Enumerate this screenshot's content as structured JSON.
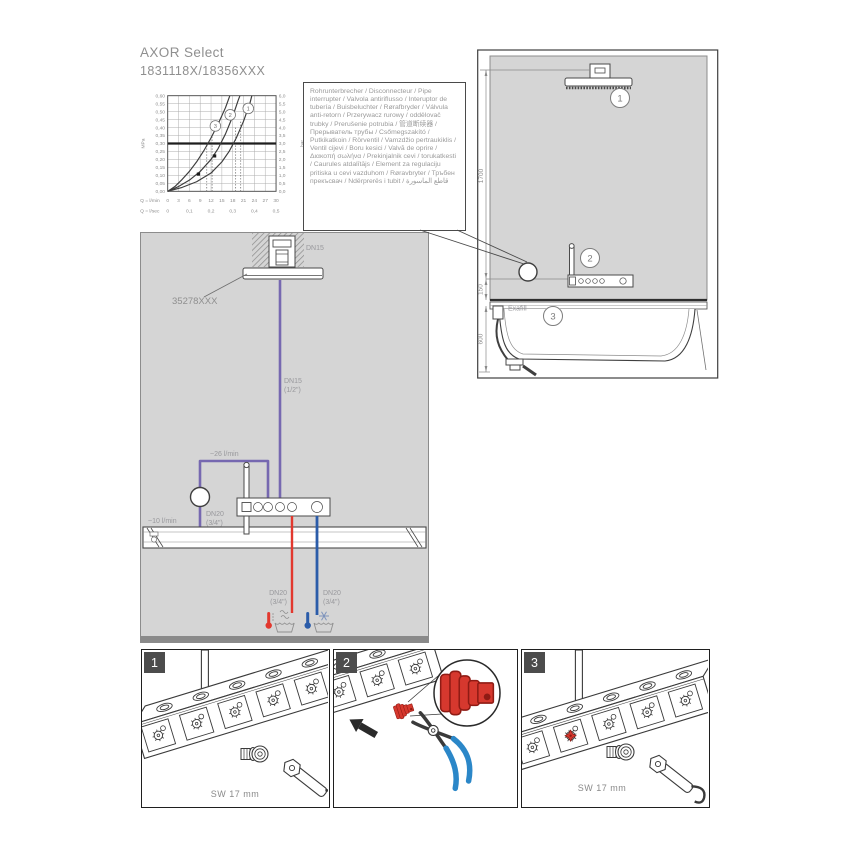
{
  "header": {
    "title": "AXOR Select",
    "subtitle": "1831118X/18356XXX"
  },
  "note_box": {
    "text": "Rohrunterbrecher / Disconnecteur / Pipe interrupter / Valvola antiriflusso / Interuptor de tubería / Buisbeluchter / Rørafbryder / Válvula anti-retorn / Przerywacz rurowy / oddělovač trubky / Prerušenie potrubia / 管道断续器 / Прерыватель трубы / Csőmegszakító / Putkikatkoin / Rörventil / Vamzdžio pertraukiklis / Ventil cijevi / Boru kesici / Valvă de oprire / Διακοπή σωλήνα / Prekinjalnik cevi / torukatkesti / Caurules atdalītājs / Element za regulaciju pritiska u cevi vazduhom / Røravbryter / Тръбен прекъсвач / Ndërprerës i tubit / قاطع الماسورة"
  },
  "chart_data": {
    "type": "line",
    "title": "",
    "xlabel_row1": "Q = l/min",
    "xlabel_row2": "Q = l/sec",
    "y_left_unit": "MPa",
    "y_right_unit": "bar",
    "x_range_lmin": [
      0,
      30
    ],
    "y_range_mpa": [
      0,
      0.6
    ],
    "grid": true,
    "y_ticks": [
      {
        "mpa": 0.6,
        "left": "0,60",
        "right": "6,0"
      },
      {
        "mpa": 0.55,
        "left": "0,55",
        "right": "5,5"
      },
      {
        "mpa": 0.5,
        "left": "0,50",
        "right": "5,0"
      },
      {
        "mpa": 0.45,
        "left": "0,45",
        "right": "4,5"
      },
      {
        "mpa": 0.4,
        "left": "0,40",
        "right": "4,0"
      },
      {
        "mpa": 0.35,
        "left": "0,35",
        "right": "3,5"
      },
      {
        "mpa": 0.3,
        "left": "0,30",
        "right": "3,0"
      },
      {
        "mpa": 0.25,
        "left": "0,25",
        "right": "2,5"
      },
      {
        "mpa": 0.2,
        "left": "0,20",
        "right": "2,0"
      },
      {
        "mpa": 0.15,
        "left": "0,15",
        "right": "1,5"
      },
      {
        "mpa": 0.1,
        "left": "0,10",
        "right": "1,0"
      },
      {
        "mpa": 0.05,
        "left": "0,05",
        "right": "0,5"
      },
      {
        "mpa": 0.0,
        "left": "0,00",
        "right": "0,0"
      }
    ],
    "x_lmin_ticks": [
      {
        "x": 0,
        "label": "0"
      },
      {
        "x": 3,
        "label": "3"
      },
      {
        "x": 6,
        "label": "6"
      },
      {
        "x": 9,
        "label": "9"
      },
      {
        "x": 12,
        "label": "12"
      },
      {
        "x": 15,
        "label": "15"
      },
      {
        "x": 18,
        "label": "18"
      },
      {
        "x": 21,
        "label": "21"
      },
      {
        "x": 24,
        "label": "24"
      },
      {
        "x": 27,
        "label": "27"
      },
      {
        "x": 30,
        "label": "30"
      }
    ],
    "x_lsec_ticks": [
      {
        "x": 0,
        "label": "0"
      },
      {
        "x": 6,
        "label": "0,1"
      },
      {
        "x": 12,
        "label": "0,2"
      },
      {
        "x": 18,
        "label": "0,3"
      },
      {
        "x": 24,
        "label": "0,4"
      },
      {
        "x": 30,
        "label": "0,5"
      }
    ],
    "reference_line_mpa": 0.3,
    "guides": [
      {
        "x": 10.8,
        "top": 0.3
      },
      {
        "x": 12.3,
        "top": 0.34
      },
      {
        "x": 18.8,
        "top": 0.4
      },
      {
        "x": 20.2,
        "top": 0.44
      }
    ],
    "markers": [
      [
        8.5,
        0.108
      ],
      [
        13,
        0.222
      ]
    ],
    "series": [
      {
        "name": "3",
        "label_at": [
          13.2,
          0.41
        ],
        "points": [
          [
            0,
            0
          ],
          [
            2,
            0.03
          ],
          [
            4,
            0.075
          ],
          [
            6,
            0.125
          ],
          [
            8,
            0.185
          ],
          [
            10,
            0.255
          ],
          [
            12,
            0.335
          ],
          [
            14,
            0.425
          ],
          [
            16,
            0.525
          ],
          [
            17.2,
            0.6
          ]
        ]
      },
      {
        "name": "2",
        "label_at": [
          17.3,
          0.48
        ],
        "points": [
          [
            0,
            0
          ],
          [
            3,
            0.03
          ],
          [
            6,
            0.07
          ],
          [
            9,
            0.125
          ],
          [
            12,
            0.2
          ],
          [
            14,
            0.27
          ],
          [
            16,
            0.36
          ],
          [
            18,
            0.47
          ],
          [
            19.5,
            0.57
          ],
          [
            20,
            0.6
          ]
        ]
      },
      {
        "name": "1",
        "label_at": [
          22.3,
          0.52
        ],
        "points": [
          [
            0,
            0
          ],
          [
            4,
            0.025
          ],
          [
            8,
            0.06
          ],
          [
            12,
            0.115
          ],
          [
            15,
            0.185
          ],
          [
            17,
            0.25
          ],
          [
            19,
            0.335
          ],
          [
            21,
            0.44
          ],
          [
            22.8,
            0.555
          ],
          [
            23.3,
            0.6
          ]
        ]
      }
    ]
  },
  "left_diagram": {
    "dn15_ceiling": "DN15",
    "product_code": "35278XXX",
    "dn15_pipe_l1": "DN15",
    "dn15_pipe_l2": "(1/2\")",
    "flow_26": "~26 l/min",
    "flow_10": "~10 l/min",
    "dn20_interrupter_l1": "DN20",
    "dn20_interrupter_l2": "(3/4\")",
    "hot_l1": "DN20",
    "hot_l2": "(3/4\")",
    "cold_l1": "DN20",
    "cold_l2": "(3/4\")"
  },
  "right_diagram": {
    "dim_1700": "1700",
    "dim_150": "150",
    "dim_600": "600",
    "exafill_label": "Exafill",
    "badge1": "1",
    "badge2": "2",
    "badge3": "3"
  },
  "steps": [
    {
      "number": "1",
      "caption": "SW 17 mm"
    },
    {
      "number": "2",
      "caption": ""
    },
    {
      "number": "3",
      "caption": "SW 17 mm"
    }
  ],
  "icons": {
    "hot_water_icon": "red thermometer over steaming water bowl",
    "cold_water_icon": "blue thermometer with snowflake over water bowl",
    "pipe_interrupter_icon": "open circle on pipe"
  },
  "colors": {
    "pipe_purple": "#7668b0",
    "pipe_red": "#e2382e",
    "pipe_blue": "#2b5ca9",
    "panel_gray": "#d5d5d5",
    "tool_blue": "#2b87c8",
    "plug_red": "#d6382e",
    "plug_red_dark": "#8f1b14",
    "label_gray": "#98989c"
  }
}
